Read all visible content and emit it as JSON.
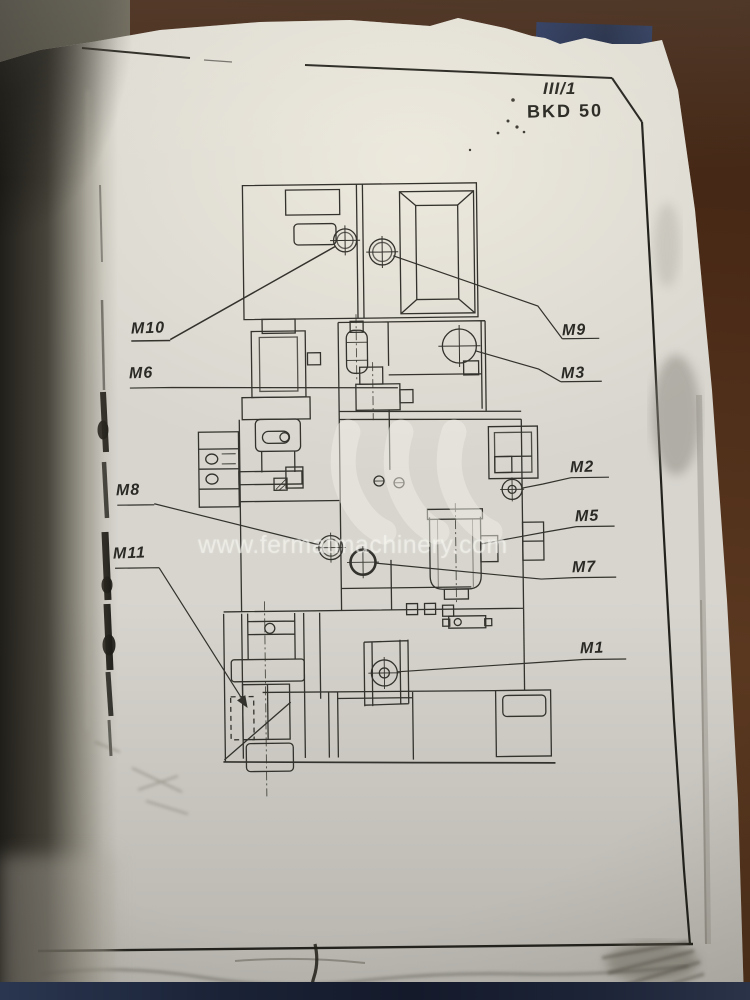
{
  "document": {
    "sheet_number": "III/1",
    "machine_model": "BKD 50"
  },
  "watermark": {
    "text": "www.fermatmachinery.com"
  },
  "component_labels": [
    {
      "text": "M10"
    },
    {
      "text": "M9"
    },
    {
      "text": "M6"
    },
    {
      "text": "M3"
    },
    {
      "text": "M2"
    },
    {
      "text": "M8"
    },
    {
      "text": "M5"
    },
    {
      "text": "M11"
    },
    {
      "text": "M7"
    },
    {
      "text": "M1"
    }
  ],
  "colors": {
    "paper": "#d7d5ce",
    "ink": "#33322c",
    "table_brown": "#4c2c18",
    "book_cover_navy": "#1d2438"
  }
}
